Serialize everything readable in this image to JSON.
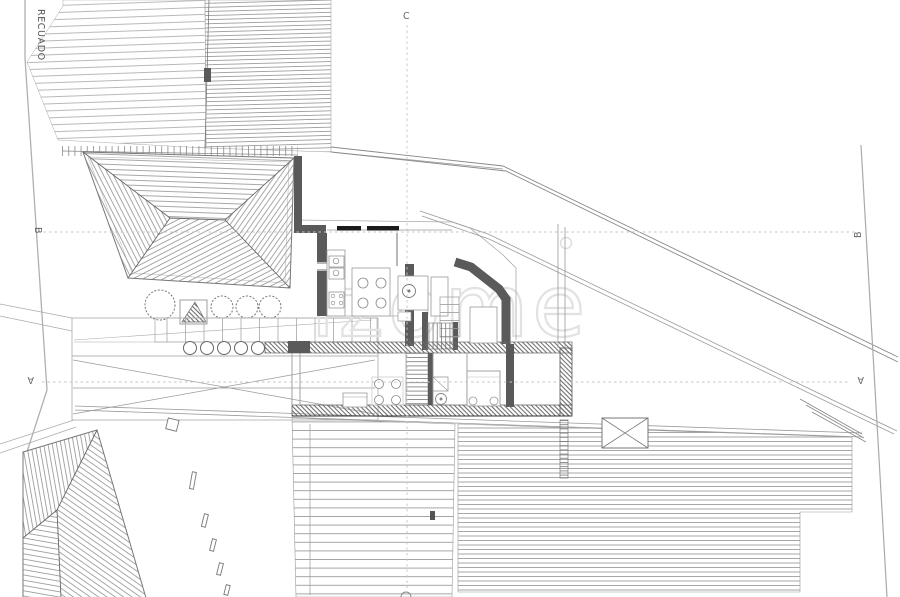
{
  "frame": {
    "setback_label": "RECUADO"
  },
  "sections": {
    "c": "C",
    "b": "B",
    "a": "A"
  },
  "watermark": {
    "text": "izome"
  },
  "colors": {
    "background": "#ffffff",
    "wall_dark": "#5a5a5a",
    "line_medium": "#8a8a8a",
    "line_light": "#aaaaaa",
    "hatch": "#8f8f8f",
    "watermark": "#e2e2e2",
    "label_text": "#666666"
  }
}
